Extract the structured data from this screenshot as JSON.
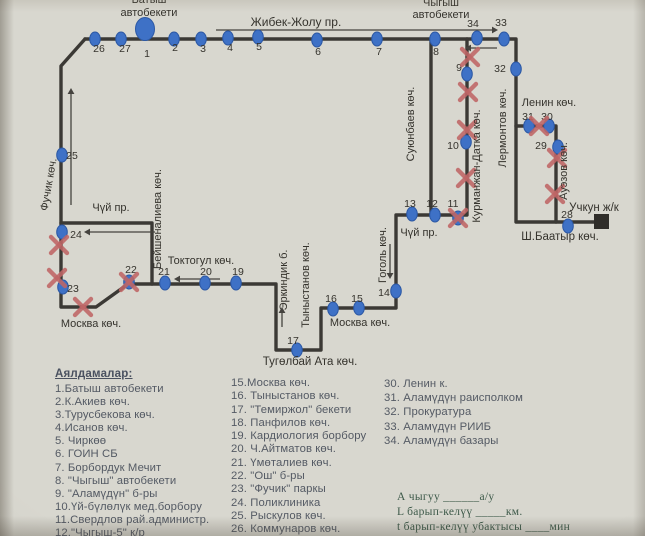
{
  "map": {
    "colors": {
      "route": "#3b3935",
      "arrow": "#45433f",
      "stop": "#3e71c6",
      "stop_border": "#2c58a4",
      "x": "#bf6666",
      "square": "#2f2d29",
      "text": "#35332d"
    },
    "lines": [
      {
        "name": "route-line-jibek-lermontov-shbaatyr",
        "points": "85,39 516,39 516,222 603,222"
      },
      {
        "name": "route-line-return-loop",
        "points": "85,39 61,66 61,307 96,307 128,284 276,284 276,350 321,350 321,308 396,308 396,215 467,215 467,39"
      },
      {
        "name": "route-line-chui-west-beishenalieva",
        "points": "61,223 152,223 152,284"
      },
      {
        "name": "route-line-suyunbaev",
        "points": "431,39 431,215"
      },
      {
        "name": "route-line-lenin-auezov",
        "points": "516,126 556,126 556,222"
      }
    ],
    "terminal_square": {
      "x": 594,
      "y": 214,
      "w": 15,
      "h": 15
    },
    "arrows": [
      {
        "x1": 216,
        "y1": 30,
        "x2": 492,
        "y2": 30,
        "w": 1.2
      },
      {
        "x1": 497,
        "y1": 48,
        "x2": 471,
        "y2": 48
      },
      {
        "x1": 71,
        "y1": 205,
        "x2": 71,
        "y2": 94
      },
      {
        "x1": 155,
        "y1": 232,
        "x2": 90,
        "y2": 232
      },
      {
        "x1": 220,
        "y1": 279,
        "x2": 180,
        "y2": 279
      },
      {
        "x1": 390,
        "y1": 244,
        "x2": 390,
        "y2": 273
      },
      {
        "x1": 282,
        "y1": 327,
        "x2": 282,
        "y2": 313
      }
    ],
    "stops": [
      {
        "n": "26",
        "x": 95,
        "y": 39,
        "lx": 99,
        "ly": 52
      },
      {
        "n": "27",
        "x": 121,
        "y": 39,
        "lx": 125,
        "ly": 52
      },
      {
        "n": "1",
        "x": 145,
        "y": 29,
        "big": true,
        "lx": 147,
        "ly": 57
      },
      {
        "n": "2",
        "x": 174,
        "y": 39,
        "lx": 175,
        "ly": 51
      },
      {
        "n": "3",
        "x": 201,
        "y": 39,
        "lx": 203,
        "ly": 52
      },
      {
        "n": "4",
        "x": 228,
        "y": 38,
        "lx": 230,
        "ly": 51
      },
      {
        "n": "5",
        "x": 258,
        "y": 37,
        "lx": 259,
        "ly": 50
      },
      {
        "n": "6",
        "x": 317,
        "y": 40,
        "lx": 318,
        "ly": 55
      },
      {
        "n": "7",
        "x": 377,
        "y": 39,
        "lx": 379,
        "ly": 55
      },
      {
        "n": "8",
        "x": 435,
        "y": 39,
        "lx": 436,
        "ly": 55
      },
      {
        "n": "34",
        "x": 477,
        "y": 38,
        "lx": 473,
        "ly": 27
      },
      {
        "n": "33",
        "x": 504,
        "y": 39,
        "lx": 501,
        "ly": 26
      },
      {
        "n": "9",
        "x": 467,
        "y": 74,
        "lx": 459,
        "ly": 71
      },
      {
        "n": "10",
        "x": 466,
        "y": 142,
        "lx": 453,
        "ly": 149
      },
      {
        "n": "32",
        "x": 516,
        "y": 69,
        "lx": 500,
        "ly": 72
      },
      {
        "n": "31",
        "x": 529,
        "y": 126,
        "lx": 528,
        "ly": 120
      },
      {
        "n": "30",
        "x": 549,
        "y": 126,
        "lx": 547,
        "ly": 120
      },
      {
        "n": "29",
        "x": 558,
        "y": 147,
        "lx": 541,
        "ly": 149
      },
      {
        "n": "28",
        "x": 568,
        "y": 226,
        "lx": 567,
        "ly": 218
      },
      {
        "n": "13",
        "x": 412,
        "y": 214,
        "lx": 410,
        "ly": 207
      },
      {
        "n": "12",
        "x": 435,
        "y": 215,
        "lx": 432,
        "ly": 207
      },
      {
        "n": "11",
        "x": 458,
        "y": 218,
        "crossed": true,
        "lx": 453,
        "ly": 207
      },
      {
        "n": "14",
        "x": 396,
        "y": 291,
        "lx": 384,
        "ly": 296
      },
      {
        "n": "15",
        "x": 359,
        "y": 308,
        "lx": 357,
        "ly": 302
      },
      {
        "n": "16",
        "x": 333,
        "y": 309,
        "lx": 331,
        "ly": 302
      },
      {
        "n": "17",
        "x": 297,
        "y": 350,
        "lx": 293,
        "ly": 344
      },
      {
        "n": "19",
        "x": 236,
        "y": 283,
        "lx": 238,
        "ly": 275
      },
      {
        "n": "20",
        "x": 205,
        "y": 283,
        "lx": 206,
        "ly": 275
      },
      {
        "n": "21",
        "x": 165,
        "y": 283,
        "lx": 164,
        "ly": 275
      },
      {
        "n": "22",
        "x": 129,
        "y": 282,
        "crossed": true,
        "lx": 131,
        "ly": 273
      },
      {
        "n": "25",
        "x": 62,
        "y": 155,
        "lx": 72,
        "ly": 159
      },
      {
        "n": "24",
        "x": 62,
        "y": 232,
        "lx": 76,
        "ly": 238
      },
      {
        "n": "23",
        "x": 63,
        "y": 287,
        "lx": 73,
        "ly": 292
      }
    ],
    "x_marks": [
      [
        470,
        57
      ],
      [
        468,
        92
      ],
      [
        467,
        130
      ],
      [
        466,
        178
      ],
      [
        539,
        126
      ],
      [
        557,
        158
      ],
      [
        555,
        194
      ],
      [
        83,
        307
      ],
      [
        59,
        245
      ],
      [
        57,
        278
      ]
    ],
    "street_labels": [
      {
        "text": "Батыш",
        "x": 149,
        "y": 3
      },
      {
        "text": "автобекети",
        "x": 149,
        "y": 16
      },
      {
        "text": "Жибек-Жолу пр.",
        "x": 296,
        "y": 26,
        "fs": 12
      },
      {
        "text": "Чыгыш",
        "x": 441,
        "y": 6
      },
      {
        "text": "автобекети",
        "x": 441,
        "y": 18
      },
      {
        "text": "Ленин көч.",
        "x": 549,
        "y": 106
      },
      {
        "text": "Лермонтов көч.",
        "x": 506,
        "y": 128,
        "rot": -90
      },
      {
        "text": "Ауэзов көч.",
        "x": 567,
        "y": 171,
        "rot": -90
      },
      {
        "text": "Учкун ж/к",
        "x": 594,
        "y": 211,
        "fs": 11.5
      },
      {
        "text": "Ш.Баатыр көч.",
        "x": 560,
        "y": 240,
        "fs": 11.5
      },
      {
        "text": "Курманжан-Датка көч.",
        "x": 480,
        "y": 166,
        "rot": -90
      },
      {
        "text": "Суюнбаев көч.",
        "x": 414,
        "y": 124,
        "rot": -90
      },
      {
        "text": "Чүй пр.",
        "x": 419,
        "y": 236
      },
      {
        "text": "Гоголь көч.",
        "x": 386,
        "y": 255,
        "rot": -90
      },
      {
        "text": "Москва көч.",
        "x": 360,
        "y": 326
      },
      {
        "text": "Тыныстанов көч.",
        "x": 309,
        "y": 285,
        "rot": -90
      },
      {
        "text": "Эркиндик б.",
        "x": 287,
        "y": 280,
        "rot": -90
      },
      {
        "text": "Тугөлбай Ата көч.",
        "x": 310,
        "y": 365,
        "fs": 11.5
      },
      {
        "text": "Токтогул көч.",
        "x": 201,
        "y": 264
      },
      {
        "text": "Бейшеналиева көч.",
        "x": 161,
        "y": 219,
        "rot": -90
      },
      {
        "text": "Чүй пр.",
        "x": 111,
        "y": 211
      },
      {
        "text": "Москва көч.",
        "x": 91,
        "y": 327
      },
      {
        "text": "Фучик көч.",
        "x": 52,
        "y": 185,
        "rot": -80
      }
    ]
  },
  "legend": {
    "header": "Аялдамалар:",
    "header_pos": {
      "x": 55,
      "y": 368
    },
    "columns": [
      {
        "x": 55,
        "y": 383,
        "lh": 13.1,
        "items": [
          "1.Батыш автобекети",
          "2.К.Акиев көч.",
          "3.Турусбекова көч.",
          "4.Исанов көч.",
          "5. Чиркөө",
          "6. ГОИН СБ",
          "7. Борбордук Мечит",
          "8. \"Чыгыш\" автобекети",
          "9. \"Аламүдүн\" б-ры",
          "10.Үй-бүлөлүк мед.борбору",
          "11.Свердлов рай.администр.",
          "12.\"Чыгыш-5\" к/р"
        ]
      },
      {
        "x": 231,
        "y": 377,
        "lh": 13.3,
        "items": [
          "15.Москва көч.",
          "16. Тыныстанов көч.",
          "17. \"Темиржол\" бекети",
          "18.  Панфилов көч.",
          "19. Кардиология борбору",
          "20. Ч.Айтматов көч.",
          "21. Үмөталиев көч.",
          "22. \"Ош\" б-ры",
          "23. \"Фучик\" паркы",
          "24. Поликлиника",
          "25. Рыскулов көч.",
          "26. Коммунаров көч."
        ]
      },
      {
        "x": 384,
        "y": 377,
        "lh": 14.2,
        "items": [
          "30. Ленин к.",
          "31. Аламүдүн раисполком",
          "32. Прокуратура",
          "33. Аламүдүн РИИБ",
          "34. Аламүдүн базары"
        ]
      }
    ]
  },
  "notes": {
    "pos": {
      "x": 397,
      "y": 490
    },
    "lines": [
      "А чыгуу  ______а/у",
      "L барып-келүү  _____км.",
      "t барып-келүү убактысы  ____мин"
    ]
  }
}
